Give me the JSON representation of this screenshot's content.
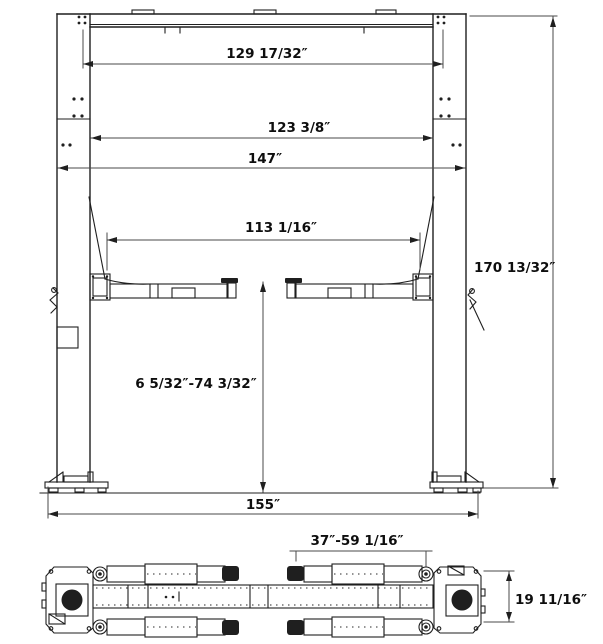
{
  "drawing": {
    "subject": "two-post automotive lift dimensional drawing",
    "background": "#ffffff",
    "line_color": "#1f1f1f",
    "front_view": {
      "top_width": "129 17/32″",
      "between_columns": "123 3/8″",
      "overall_width": "147″",
      "inner_span": "113 1/16″",
      "overall_height": "170 13/32″",
      "lift_range": "6 5/32″-74 3/32″",
      "base_width": "155″"
    },
    "plan_view": {
      "arm_reach": "37″-59 1/16″",
      "track_depth": "19 11/16″"
    }
  }
}
